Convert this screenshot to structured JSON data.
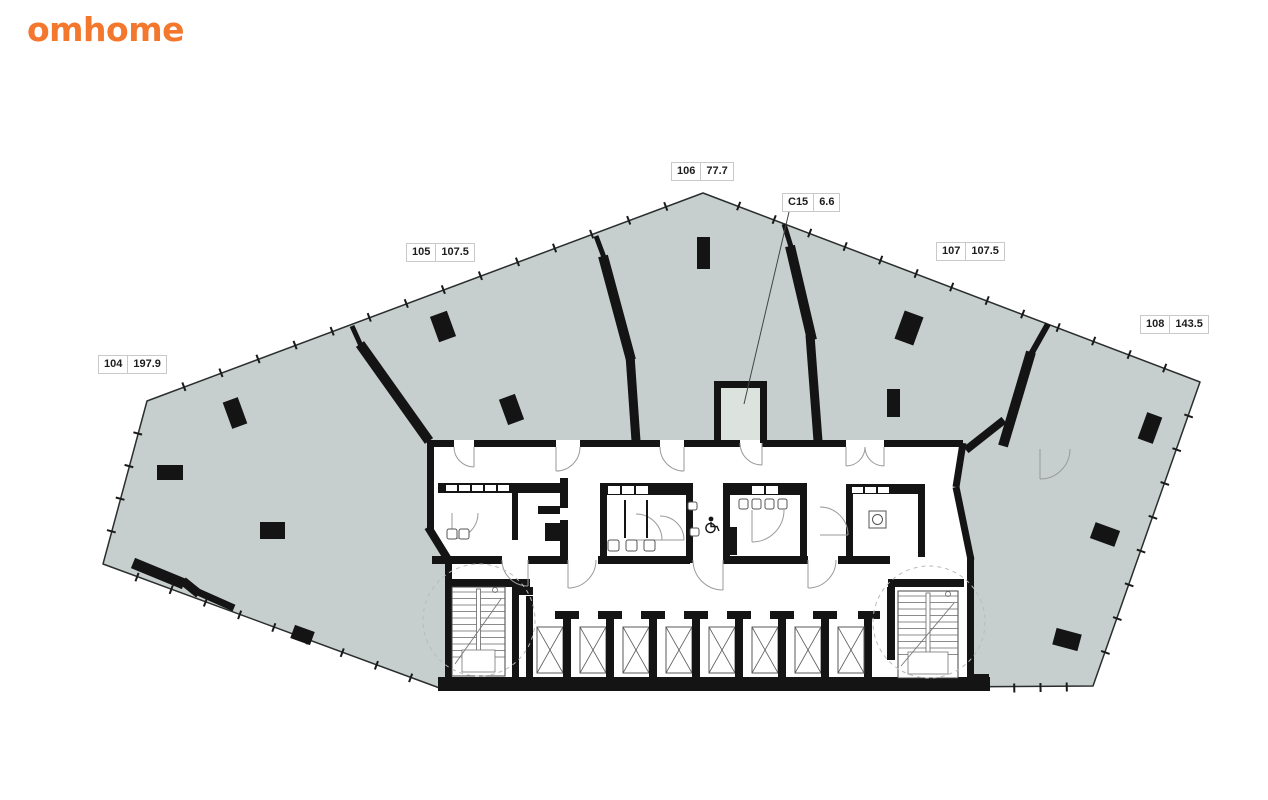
{
  "brand": {
    "logo_text": "omhome",
    "logo_color": "#f4772e"
  },
  "floor_plan": {
    "units": [
      {
        "id": "104",
        "area": "197.9"
      },
      {
        "id": "105",
        "area": "107.5"
      },
      {
        "id": "106",
        "area": "77.7"
      },
      {
        "id": "107",
        "area": "107.5"
      },
      {
        "id": "108",
        "area": "143.5"
      },
      {
        "id": "C15",
        "area": "6.6"
      }
    ],
    "colors": {
      "floor_fill": "#c6cfce",
      "wall": "#141414",
      "c15_room_fill": "#dce3df",
      "label_border": "#c9c9c9"
    }
  }
}
